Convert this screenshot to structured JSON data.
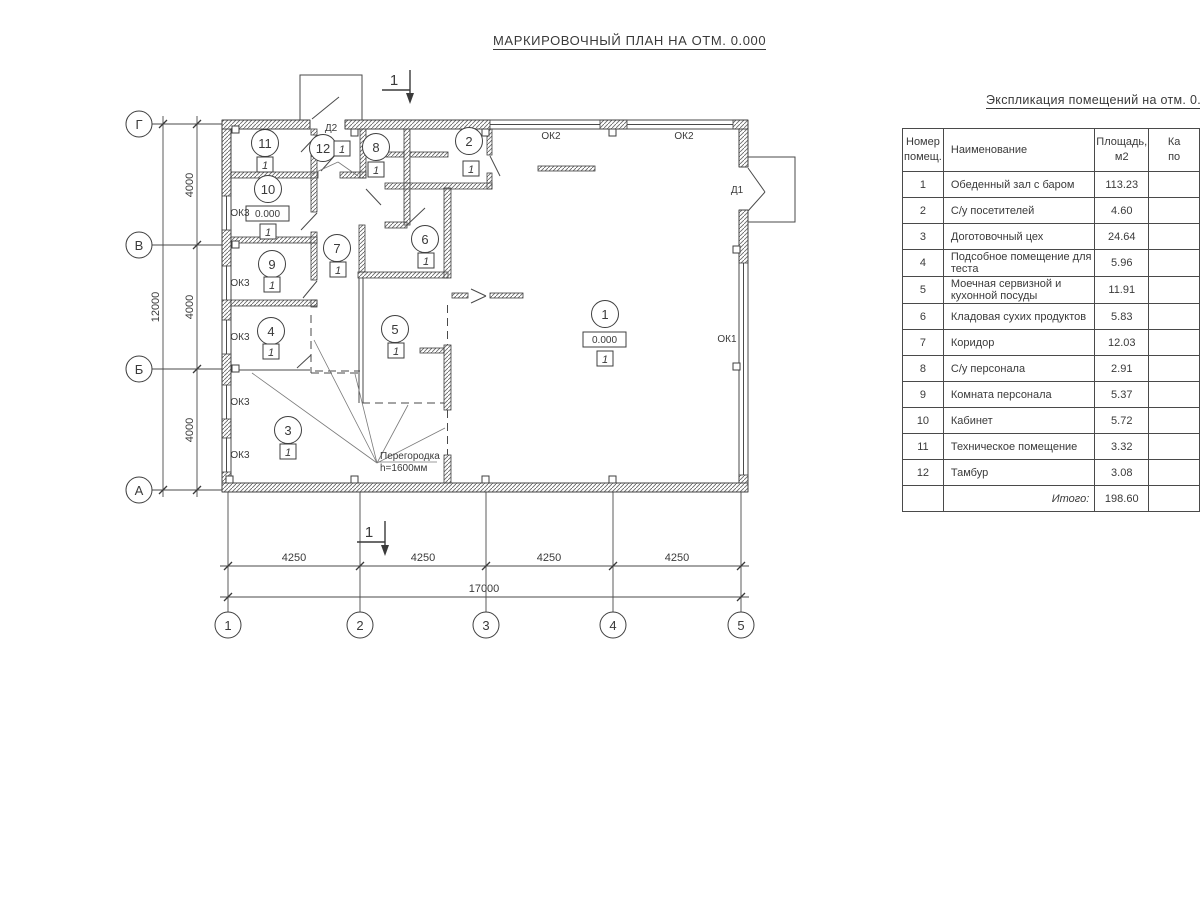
{
  "plan": {
    "title": "МАРКИРОВОЧНЫЙ ПЛАН НА ОТМ. 0.000",
    "section_label": "1",
    "axes_horizontal": [
      "Г",
      "В",
      "Б",
      "А"
    ],
    "axes_vertical": [
      "1",
      "2",
      "3",
      "4",
      "5"
    ],
    "dims": {
      "v_segments": [
        "4000",
        "4000",
        "4000"
      ],
      "v_total": "12000",
      "h_segments": [
        "4250",
        "4250",
        "4250",
        "4250"
      ],
      "h_total": "17000"
    },
    "rooms": [
      "1",
      "2",
      "3",
      "4",
      "5",
      "6",
      "7",
      "8",
      "9",
      "10",
      "11",
      "12"
    ],
    "labels": {
      "door_d1": "Д1",
      "door_d2": "Д2",
      "window_ok1": "ОК1",
      "window_ok2": "ОК2",
      "window_ok3": "ОК3",
      "elevation": "0.000",
      "floor_mark": "1",
      "partition_line1": "Перегородка",
      "partition_line2": "h=1600мм"
    }
  },
  "explication": {
    "title": "Экспликация помещений на отм. 0.000",
    "headers": {
      "num": "Номер\nпомещ.",
      "name": "Наименование",
      "area": "Площадь,\nм2",
      "category": "Ка\nпо"
    },
    "rows": [
      {
        "num": "1",
        "name": "Обеденный зал с баром",
        "area": "113.23"
      },
      {
        "num": "2",
        "name": "С/у посетителей",
        "area": "4.60"
      },
      {
        "num": "3",
        "name": "Доготовочный цех",
        "area": "24.64"
      },
      {
        "num": "4",
        "name": "Подсобное помещение для теста",
        "area": "5.96"
      },
      {
        "num": "5",
        "name": "Моечная сервизной и кухонной посуды",
        "area": "11.91"
      },
      {
        "num": "6",
        "name": "Кладовая сухих продуктов",
        "area": "5.83"
      },
      {
        "num": "7",
        "name": "Коридор",
        "area": "12.03"
      },
      {
        "num": "8",
        "name": "С/у персонала",
        "area": "2.91"
      },
      {
        "num": "9",
        "name": "Комната персонала",
        "area": "5.37"
      },
      {
        "num": "10",
        "name": "Кабинет",
        "area": "5.72"
      },
      {
        "num": "11",
        "name": "Техническое помещение",
        "area": "3.32"
      },
      {
        "num": "12",
        "name": "Тамбур",
        "area": "3.08"
      }
    ],
    "total_label": "Итого:",
    "total_area": "198.60"
  }
}
